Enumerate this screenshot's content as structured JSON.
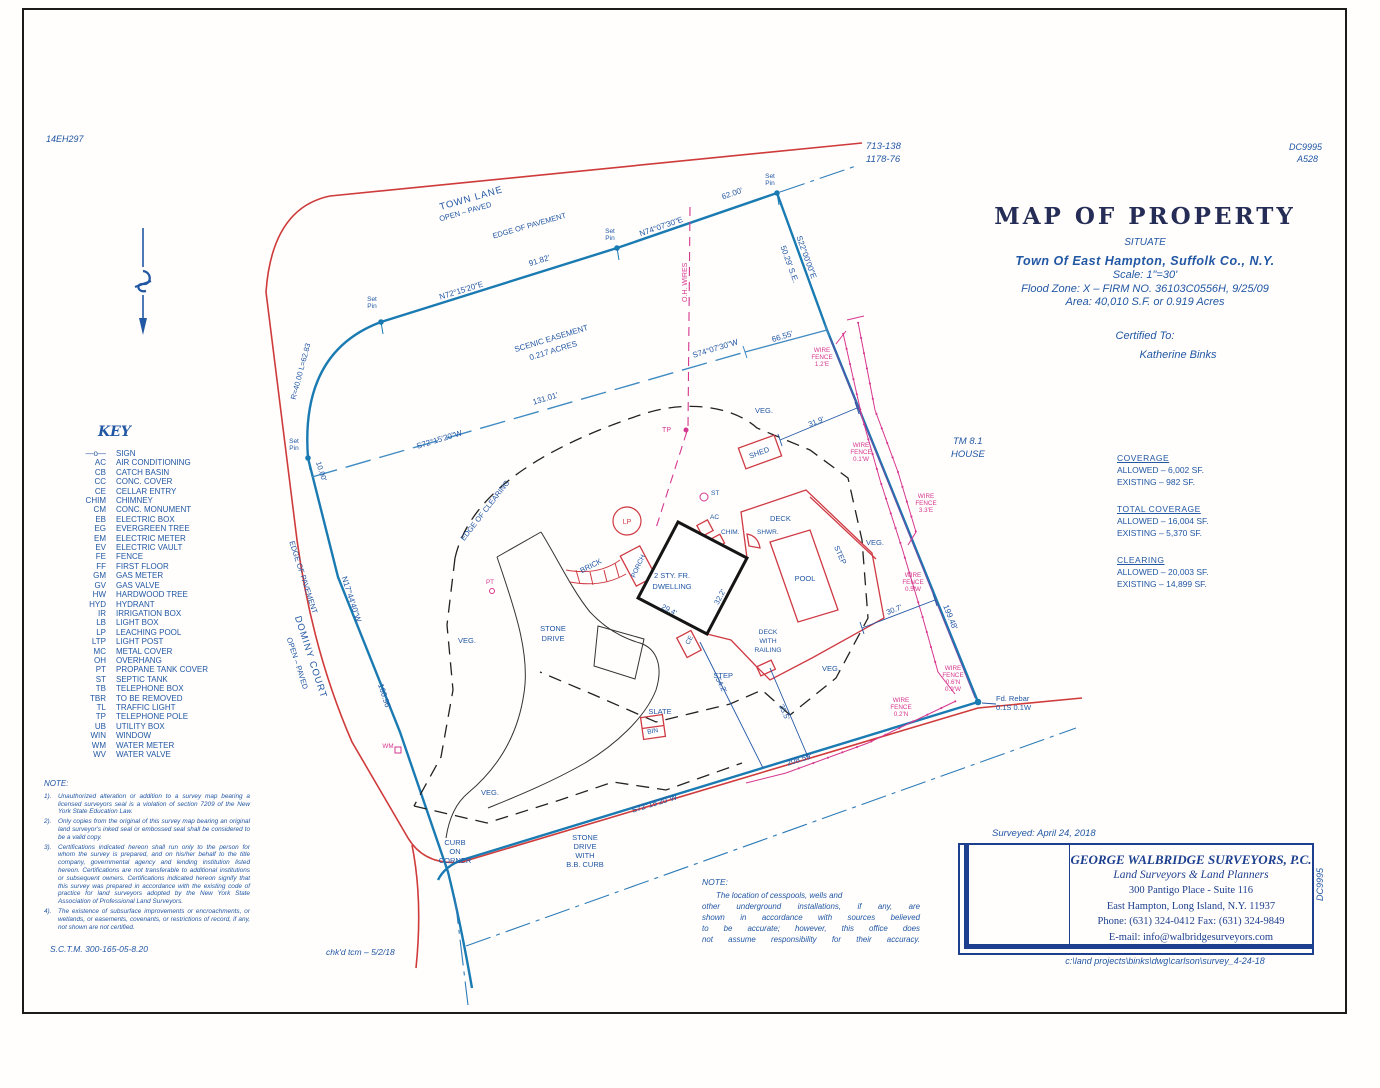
{
  "refs": {
    "top_left": "14EH297",
    "plate_a": "713-138",
    "plate_b": "1178-76",
    "top_right_a": "DC9995",
    "top_right_b": "A528",
    "side_vertical": "DC9995"
  },
  "title_block": {
    "title": "MAP OF PROPERTY",
    "situate": "SITUATE",
    "town": "Town Of East Hampton, Suffolk Co., N.Y.",
    "scale": "Scale: 1\"=30'",
    "flood": "Flood Zone: X – FIRM NO. 36103C0556H, 9/25/09",
    "area": "Area: 40,010 S.F. or 0.919 Acres",
    "certified": "Certified To:",
    "certified_name": "Katherine Binks"
  },
  "key": {
    "title": "KEY",
    "items": [
      {
        "abbr": "—o—",
        "label": "SIGN"
      },
      {
        "abbr": "AC",
        "label": "AIR CONDITIONING"
      },
      {
        "abbr": "CB",
        "label": "CATCH BASIN"
      },
      {
        "abbr": "CC",
        "label": "CONC. COVER"
      },
      {
        "abbr": "CE",
        "label": "CELLAR ENTRY"
      },
      {
        "abbr": "CHIM",
        "label": "CHIMNEY"
      },
      {
        "abbr": "CM",
        "label": "CONC. MONUMENT"
      },
      {
        "abbr": "EB",
        "label": "ELECTRIC BOX"
      },
      {
        "abbr": "EG",
        "label": "EVERGREEN TREE"
      },
      {
        "abbr": "EM",
        "label": "ELECTRIC METER"
      },
      {
        "abbr": "EV",
        "label": "ELECTRIC VAULT"
      },
      {
        "abbr": "FE",
        "label": "FENCE"
      },
      {
        "abbr": "FF",
        "label": "FIRST FLOOR"
      },
      {
        "abbr": "GM",
        "label": "GAS METER"
      },
      {
        "abbr": "GV",
        "label": "GAS VALVE"
      },
      {
        "abbr": "HW",
        "label": "HARDWOOD TREE"
      },
      {
        "abbr": "HYD",
        "label": "HYDRANT"
      },
      {
        "abbr": "IR",
        "label": "IRRIGATION BOX"
      },
      {
        "abbr": "LB",
        "label": "LIGHT BOX"
      },
      {
        "abbr": "LP",
        "label": "LEACHING POOL"
      },
      {
        "abbr": "LTP",
        "label": "LIGHT POST"
      },
      {
        "abbr": "MC",
        "label": "METAL COVER"
      },
      {
        "abbr": "OH",
        "label": "OVERHANG"
      },
      {
        "abbr": "PT",
        "label": "PROPANE TANK COVER"
      },
      {
        "abbr": "ST",
        "label": "SEPTIC TANK"
      },
      {
        "abbr": "TB",
        "label": "TELEPHONE BOX"
      },
      {
        "abbr": "TBR",
        "label": "TO BE REMOVED"
      },
      {
        "abbr": "TL",
        "label": "TRAFFIC LIGHT"
      },
      {
        "abbr": "TP",
        "label": "TELEPHONE POLE"
      },
      {
        "abbr": "UB",
        "label": "UTILITY BOX"
      },
      {
        "abbr": "WIN",
        "label": "WINDOW"
      },
      {
        "abbr": "WM",
        "label": "WATER METER"
      },
      {
        "abbr": "WV",
        "label": "WATER VALVE"
      }
    ]
  },
  "coverage": {
    "blocks": [
      {
        "heading": "COVERAGE",
        "allowed": "ALLOWED – 6,002 SF.",
        "existing": "EXISTING – 982 SF."
      },
      {
        "heading": "TOTAL COVERAGE",
        "allowed": "ALLOWED – 16,004 SF.",
        "existing": "EXISTING – 5,370 SF."
      },
      {
        "heading": "CLEARING",
        "allowed": "ALLOWED – 20,003 SF.",
        "existing": "EXISTING – 14,899 SF."
      }
    ]
  },
  "notes": {
    "heading": "NOTE:",
    "items": [
      {
        "num": "1).",
        "text": "Unauthorized alteration or addition to a survey map bearing a licensed surveyors seal is a violation of section 7209 of the New York State Education Law."
      },
      {
        "num": "2).",
        "text": "Only copies from the original of this survey map bearing an original land surveyor's inked seal or embossed seal shall be considered to be a valid copy."
      },
      {
        "num": "3).",
        "text": "Certifications indicated hereon shall run only to the person for whom the survey is prepared, and on his/her behalf to the title company, governmental agency and lending institution listed hereon. Certifications are not transferable to additional institutions or subsequent owners. Certifications indicated hereon signify that this survey was prepared in accordance with the existing code of practice for land surveyors adopted by the New York State Association of Professional Land Surveyors."
      },
      {
        "num": "4).",
        "text": "The existence of subsurface improvements or encroachments, or wetlands, or easements, covenants, or restrictions of record, if any, not shown are not certified."
      }
    ],
    "sctm": "S.C.T.M.  300-165-05-8.20"
  },
  "note2": {
    "heading": "NOTE:",
    "lines": [
      "The location of cesspools, wells and",
      "other underground installations, if any, are",
      "shown in accordance with sources believed",
      "to be accurate; however, this office does",
      "not assume responsibility for their accuracy."
    ]
  },
  "checked": "chk'd tcm – 5/2/18",
  "surveyor": {
    "surveyed": "Surveyed: April 24, 2018",
    "company": "GEORGE WALBRIDGE SURVEYORS, P.C.",
    "tagline": "Land Surveyors & Land Planners",
    "address1": "300 Pantigo Place - Suite 116",
    "address2": "East Hampton, Long Island, N.Y. 11937",
    "phone": "Phone: (631) 324-0412   Fax: (631) 324-9849",
    "email": "E-mail: info@walbridgesurveyors.com",
    "filepath": "c:\\land  projects\\binks\\dwg\\carlson\\survey_4-24-18"
  },
  "map": {
    "town_lane": "TOWN LANE",
    "open_paved": "OPEN – PAVED",
    "dominy": "DOMINY COURT",
    "edge_pavement": "EDGE OF PAVEMENT",
    "brg_n72": "N72°15'20\"E",
    "d_9182": "91.82'",
    "brg_n74": "N74°07'30\"E",
    "d_6200": "62.00'",
    "brg_s22": "S22°00'00\"E",
    "d_5029": "50.29' S.E.",
    "brg_s74w": "S74°07'30\"W",
    "d_6655": "66.55'",
    "scenic1": "SCENIC EASEMENT",
    "scenic2": "0.217 ACRES",
    "d_13101": "131.01'",
    "brg_s72": "S72°15'20\"W",
    "d_20859": "208.59'",
    "brg_n17": "N17°44'40\"W",
    "d_16096": "160.96'",
    "d_19948": "199.48'",
    "d_1000": "10.00'",
    "curve": "R=40.00 L=62.83",
    "set_pin": [
      "Set",
      "Pin"
    ],
    "fd_rebar": [
      "Fd. Rebar",
      "0.1S  0.1W"
    ],
    "oh_wires": "O.H. WIRES",
    "edge_clearing": "EDGE OF CLEARING",
    "tm1": "TM  8.1",
    "tm2": "HOUSE",
    "shed": "SHED",
    "d_319": "31.9'",
    "d_307": "30.7'",
    "d_542": "54.2'",
    "d_355": "35.5'",
    "d_294": "29.4'",
    "d_322": "32.2'",
    "wf_12e": [
      "WIRE",
      "FENCE",
      "1.2'E"
    ],
    "wf_01w": [
      "WIRE",
      "FENCE",
      "0.1'W"
    ],
    "wf_33e": [
      "WIRE",
      "FENCE",
      "3.3'E"
    ],
    "wf_05w": [
      "WIRE",
      "FENCE",
      "0.5'W"
    ],
    "wf_06n": [
      "WIRE",
      "FENCE",
      "0.6'N",
      "0.9'W"
    ],
    "wf_02n": [
      "WIRE",
      "FENCE",
      "0.2'N"
    ],
    "veg": "VEG.",
    "pool": "POOL",
    "deck": "DECK",
    "deck_railing": [
      "DECK",
      "WITH",
      "RAILING"
    ],
    "step": "STEP",
    "slate": "SLATE",
    "bin": "BIN",
    "dwelling": [
      "2 STY. FR.",
      "DWELLING"
    ],
    "porch": "PORCH",
    "brick": "BRICK",
    "ce": "CE",
    "ac": "AC",
    "chim": "CHIM.",
    "shwr": "SHWR.",
    "st": "ST",
    "lp": "LP",
    "tp": "TP",
    "pt": "PT",
    "wm": "WM",
    "stone_drive": [
      "STONE",
      "DRIVE"
    ],
    "curb": [
      "CURB",
      "ON",
      "CORNER"
    ],
    "stone_bb": [
      "STONE",
      "DRIVE",
      "WITH",
      "B.B. CURB"
    ]
  }
}
